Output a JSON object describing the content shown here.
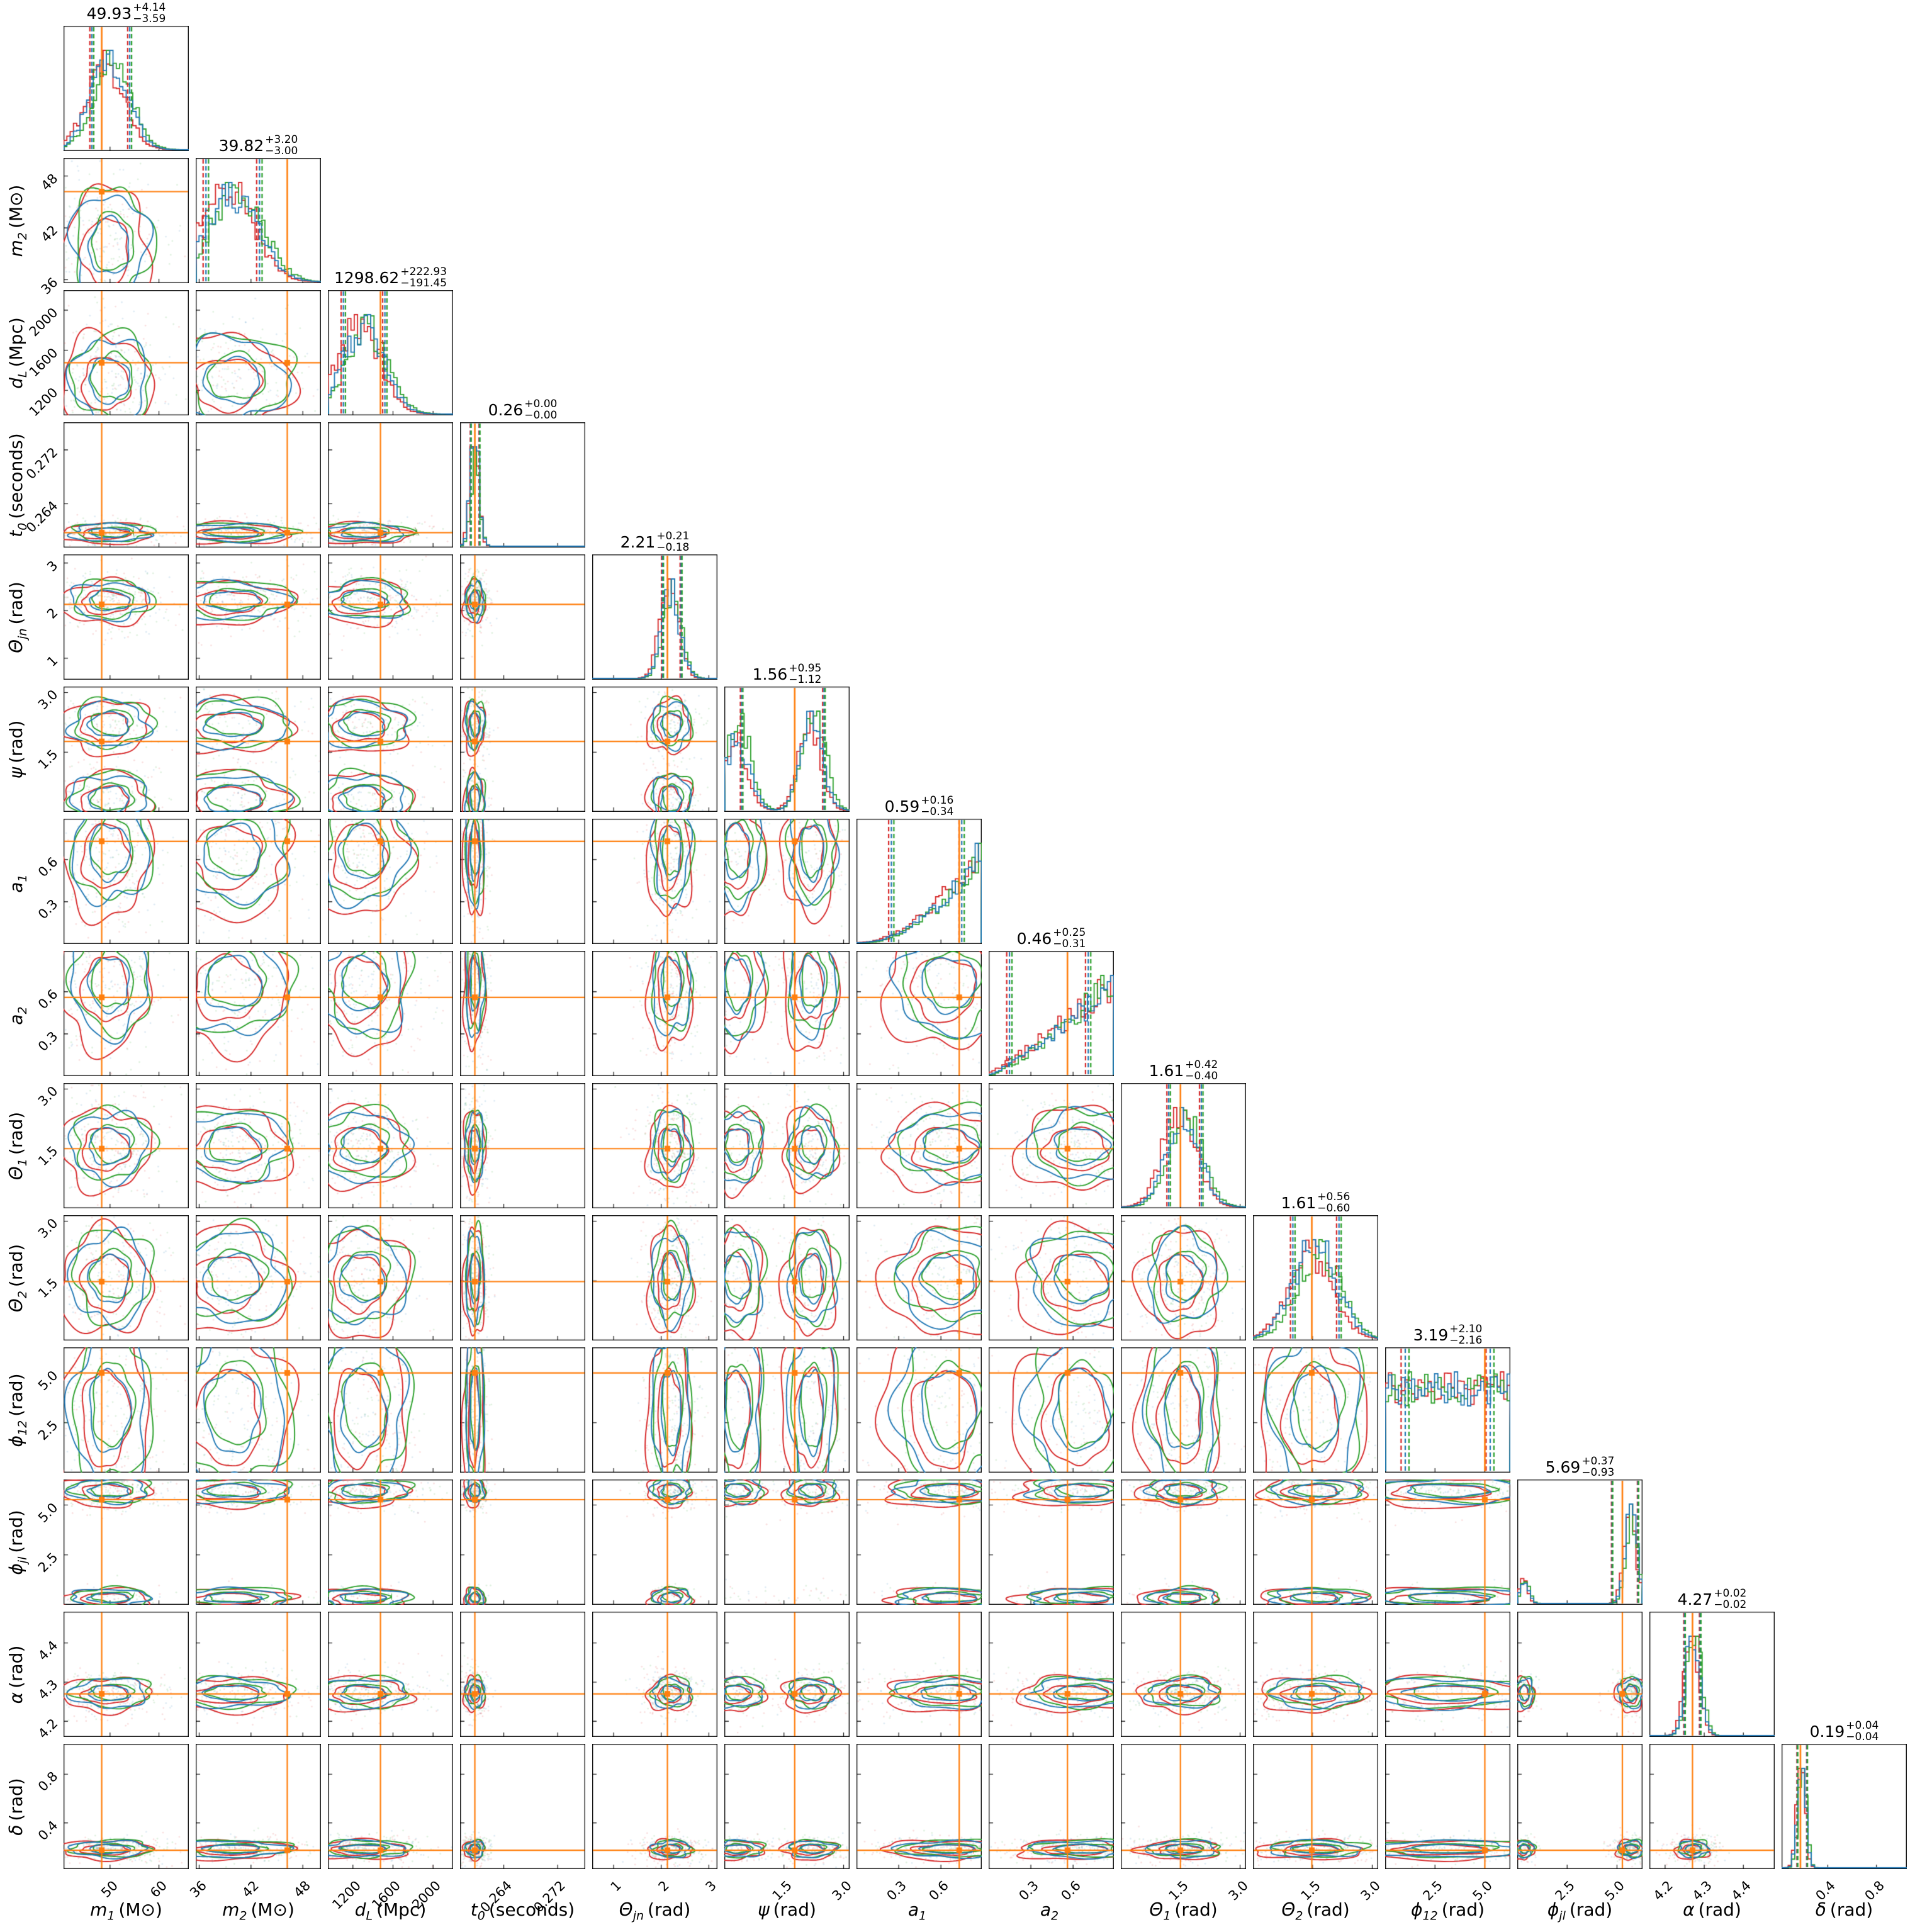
{
  "figure": {
    "kind": "corner plot, 14 gravitational-wave parameters, 3 overlaid analyses with truth lines",
    "background": "#ffffff"
  },
  "chart_data": {
    "type": "corner",
    "n_series": 3,
    "series": {
      "colors": [
        "#d62728",
        "#2077b4",
        "#2ca02c"
      ],
      "mu_offset_sigma": [
        -0.22,
        -0.02,
        0.16
      ],
      "sigma_scale": [
        1.18,
        1.0,
        1.03
      ]
    },
    "truth_color": "#ff7f0e",
    "legend": "none",
    "grid": "off",
    "parameters": [
      {
        "id": "m1",
        "axis_label": {
          "var": "m",
          "sub": "1",
          "unit": "(M⊙)"
        },
        "title": {
          "median": "49.93",
          "plus": "+4.14",
          "minus": "−3.59"
        },
        "median": 49.93,
        "q16": 46.34,
        "q84": 54.07,
        "range": [
          40.5,
          66.1
        ],
        "ticks": [
          50,
          60
        ],
        "tick_labels": [
          "50",
          "60"
        ],
        "truth": 48.3,
        "dist": {
          "type": "gauss",
          "mu": 49.9,
          "sigma": 3.8
        }
      },
      {
        "id": "m2",
        "axis_label": {
          "var": "m",
          "sub": "2",
          "unit": "(M⊙)"
        },
        "title": {
          "median": "39.82",
          "plus": "+3.20",
          "minus": "−3.00"
        },
        "median": 39.82,
        "q16": 36.82,
        "q84": 43.02,
        "range": [
          35.6,
          50.1
        ],
        "ticks": [
          36,
          42,
          48
        ],
        "tick_labels": [
          "36",
          "42",
          "48"
        ],
        "truth": 46.2,
        "dist": {
          "type": "gauss",
          "mu": 39.9,
          "sigma": 3.0
        }
      },
      {
        "id": "dL",
        "axis_label": {
          "var": "d",
          "sub": "L",
          "unit": "(Mpc)"
        },
        "title": {
          "median": "1298.62",
          "plus": "+222.93",
          "minus": "−191.45"
        },
        "median": 1298.62,
        "q16": 1107.17,
        "q84": 1521.55,
        "range": [
          950,
          2200
        ],
        "ticks": [
          1200,
          1600,
          2000
        ],
        "tick_labels": [
          "1200",
          "1600",
          "2000"
        ],
        "truth": 1475,
        "dist": {
          "type": "gauss",
          "mu": 1305,
          "sigma": 205
        }
      },
      {
        "id": "t0",
        "axis_label": {
          "var": "t",
          "sub": "0",
          "unit": "(seconds)"
        },
        "title": {
          "median": "0.26",
          "plus": "+0.00",
          "minus": "−0.00"
        },
        "median": 0.2597,
        "q16": 0.2591,
        "q84": 0.2604,
        "range": [
          0.2575,
          0.2761
        ],
        "ticks": [
          0.264,
          0.272
        ],
        "tick_labels": [
          "0.264",
          "0.272"
        ],
        "truth": 0.2597,
        "dist": {
          "type": "gauss",
          "mu": 0.2597,
          "sigma": 0.00065
        }
      },
      {
        "id": "thetajn",
        "axis_label": {
          "var": "Θ",
          "sub": "jn",
          "unit": "(rad)"
        },
        "title": {
          "median": "2.21",
          "plus": "+0.21",
          "minus": "−0.18"
        },
        "median": 2.21,
        "q16": 2.03,
        "q84": 2.42,
        "range": [
          0.55,
          3.18
        ],
        "ticks": [
          1,
          2,
          3
        ],
        "tick_labels": [
          "1",
          "2",
          "3"
        ],
        "truth": 2.13,
        "dist": {
          "type": "gauss",
          "mu": 2.21,
          "sigma": 0.19
        }
      },
      {
        "id": "psi",
        "axis_label": {
          "var": "ψ",
          "sub": "",
          "unit": "(rad)"
        },
        "title": {
          "median": "1.56",
          "plus": "+0.95",
          "minus": "−1.12"
        },
        "median": 1.56,
        "q16": 0.44,
        "q84": 2.51,
        "range": [
          0,
          3.15
        ],
        "ticks": [
          1.5,
          3.0
        ],
        "tick_labels": [
          "1.5",
          "3.0"
        ],
        "truth": 1.77,
        "dist": {
          "type": "bimodal",
          "modes": [
            {
              "mu": 0.32,
              "sigma": 0.3,
              "w": 0.45
            },
            {
              "mu": 2.2,
              "sigma": 0.28,
              "w": 0.55
            }
          ]
        }
      },
      {
        "id": "a1",
        "axis_label": {
          "var": "a",
          "sub": "1",
          "unit": ""
        },
        "title": {
          "median": "0.59",
          "plus": "+0.16",
          "minus": "−0.34"
        },
        "median": 0.59,
        "q16": 0.25,
        "q84": 0.75,
        "range": [
          0,
          0.89
        ],
        "ticks": [
          0.3,
          0.6
        ],
        "tick_labels": [
          "0.3",
          "0.6"
        ],
        "truth": 0.73,
        "dist": {
          "type": "rising",
          "power": 2.2
        }
      },
      {
        "id": "a2",
        "axis_label": {
          "var": "a",
          "sub": "2",
          "unit": ""
        },
        "title": {
          "median": "0.46",
          "plus": "+0.25",
          "minus": "−0.31"
        },
        "median": 0.46,
        "q16": 0.15,
        "q84": 0.71,
        "range": [
          0,
          0.89
        ],
        "ticks": [
          0.3,
          0.6
        ],
        "tick_labels": [
          "0.3",
          "0.6"
        ],
        "truth": 0.56,
        "dist": {
          "type": "rising",
          "power": 1.2
        }
      },
      {
        "id": "theta1",
        "axis_label": {
          "var": "Θ",
          "sub": "1",
          "unit": "(rad)"
        },
        "title": {
          "median": "1.61",
          "plus": "+0.42",
          "minus": "−0.40"
        },
        "median": 1.61,
        "q16": 1.21,
        "q84": 2.03,
        "range": [
          0,
          3.15
        ],
        "ticks": [
          1.5,
          3.0
        ],
        "tick_labels": [
          "1.5",
          "3.0"
        ],
        "truth": 1.5,
        "dist": {
          "type": "gauss",
          "mu": 1.57,
          "sigma": 0.42
        }
      },
      {
        "id": "theta2",
        "axis_label": {
          "var": "Θ",
          "sub": "2",
          "unit": "(rad)"
        },
        "title": {
          "median": "1.61",
          "plus": "+0.56",
          "minus": "−0.60"
        },
        "median": 1.61,
        "q16": 1.01,
        "q84": 2.17,
        "range": [
          0,
          3.15
        ],
        "ticks": [
          1.5,
          3.0
        ],
        "tick_labels": [
          "1.5",
          "3.0"
        ],
        "truth": 1.48,
        "dist": {
          "type": "gauss",
          "mu": 1.57,
          "sigma": 0.55
        }
      },
      {
        "id": "phi12",
        "axis_label": {
          "var": "ϕ",
          "sub": "12",
          "unit": "(rad)"
        },
        "title": {
          "median": "3.19",
          "plus": "+2.10",
          "minus": "−2.16"
        },
        "median": 3.19,
        "q16": 1.03,
        "q84": 5.29,
        "range": [
          0,
          6.28
        ],
        "ticks": [
          2.5,
          5.0
        ],
        "tick_labels": [
          "2.5",
          "5.0"
        ],
        "truth": 5.0,
        "dist": {
          "type": "flat"
        }
      },
      {
        "id": "phijl",
        "axis_label": {
          "var": "ϕ",
          "sub": "jl",
          "unit": "(rad)"
        },
        "title": {
          "median": "5.69",
          "plus": "+0.37",
          "minus": "−0.93"
        },
        "median": 5.69,
        "q16": 4.76,
        "q84": 6.06,
        "range": [
          0,
          6.28
        ],
        "ticks": [
          2.5,
          5.0
        ],
        "tick_labels": [
          "2.5",
          "5.0"
        ],
        "truth": 5.27,
        "dist": {
          "type": "bimodal",
          "modes": [
            {
              "mu": 5.72,
              "sigma": 0.3,
              "w": 0.8
            },
            {
              "mu": 0.35,
              "sigma": 0.22,
              "w": 0.2
            }
          ]
        }
      },
      {
        "id": "alpha",
        "axis_label": {
          "var": "α",
          "sub": "",
          "unit": "(rad)"
        },
        "title": {
          "median": "4.27",
          "plus": "+0.02",
          "minus": "−0.02"
        },
        "median": 4.27,
        "q16": 4.25,
        "q84": 4.29,
        "range": [
          4.16,
          4.48
        ],
        "ticks": [
          4.2,
          4.3,
          4.4
        ],
        "tick_labels": [
          "4.2",
          "4.3",
          "4.4"
        ],
        "truth": 4.27,
        "dist": {
          "type": "gauss",
          "mu": 4.272,
          "sigma": 0.018
        }
      },
      {
        "id": "delta",
        "axis_label": {
          "var": "δ",
          "sub": "",
          "unit": "(rad)"
        },
        "title": {
          "median": "0.19",
          "plus": "+0.04",
          "minus": "−0.04"
        },
        "median": 0.19,
        "q16": 0.15,
        "q84": 0.23,
        "range": [
          0.02,
          1.05
        ],
        "ticks": [
          0.4,
          0.8
        ],
        "tick_labels": [
          "0.4",
          "0.8"
        ],
        "truth": 0.175,
        "dist": {
          "type": "gauss",
          "mu": 0.185,
          "sigma": 0.033
        }
      }
    ]
  }
}
